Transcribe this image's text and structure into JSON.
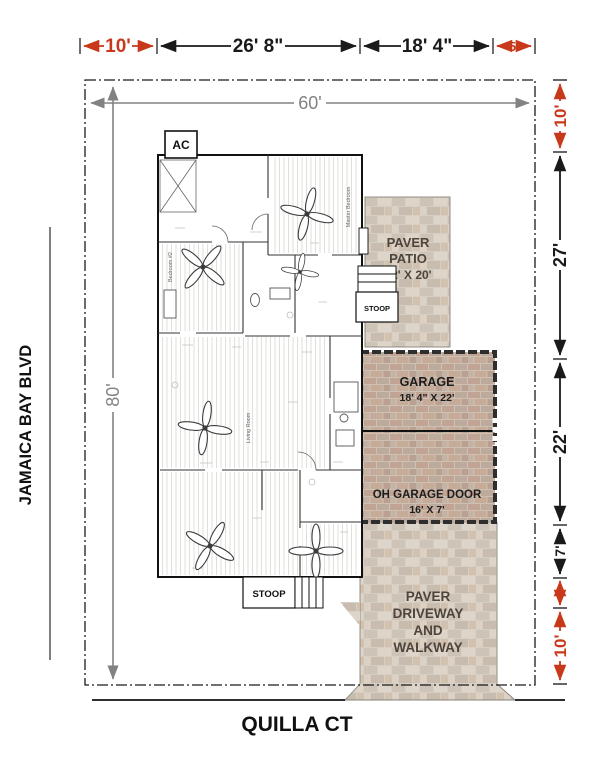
{
  "drawing": {
    "streets": {
      "left": "JAMAICA BAY BLVD",
      "bottom": "QUILLA CT"
    },
    "lot": {
      "width": "60'",
      "depth": "80'"
    },
    "top_dims": {
      "s1": "10'",
      "s2": "26' 8\"",
      "s3": "18' 4\"",
      "s4": "5'"
    },
    "right_dims": {
      "s1": "10'",
      "s2": "27'",
      "s3": "22'",
      "s4": "7'",
      "s5": "4'",
      "s6": "10'"
    },
    "house": {
      "ac": "AC",
      "stoop_rear": "STOOP",
      "stoop_front": "STOOP",
      "master_bedroom": "Master Bedroom",
      "living_room": "Living Room",
      "bedroom2": "Bedroom #2"
    },
    "patio": {
      "l1": "PAVER",
      "l2": "PATIO",
      "l3": "12' X 20'"
    },
    "garage": {
      "l1": "GARAGE",
      "l2": "18' 4\" X 22'",
      "door_l1": "OH GARAGE DOOR",
      "door_l2": "16' X 7'"
    },
    "driveway": {
      "l1": "PAVER",
      "l2": "DRIVEWAY",
      "l3": "AND",
      "l4": "WALKWAY"
    },
    "colors": {
      "dimension_red": "#c8381b",
      "dimension_black": "#1a1a1a",
      "dimension_gray": "#828282",
      "paver_label": "#4e443b"
    }
  }
}
